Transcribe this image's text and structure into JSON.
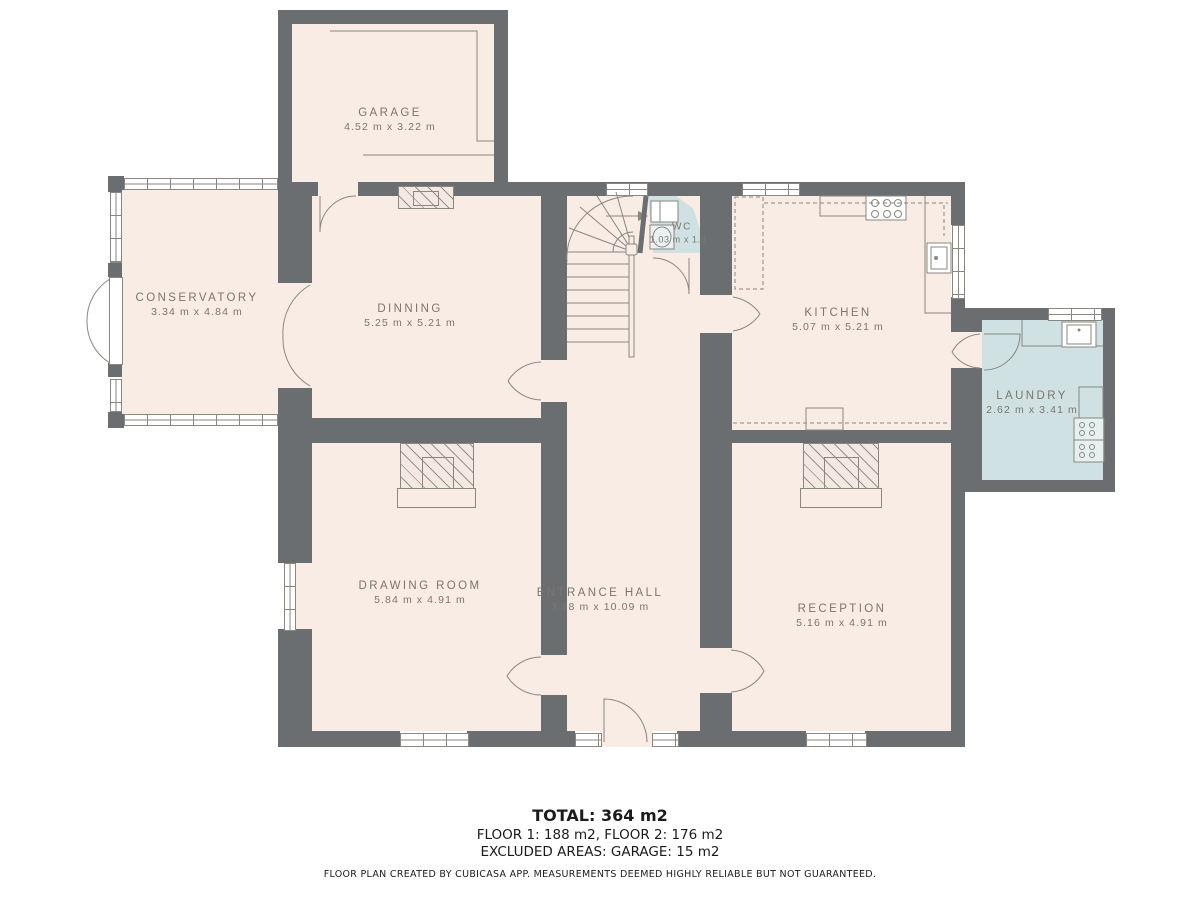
{
  "plan": {
    "title": "floor-plan",
    "rooms": [
      {
        "id": "garage",
        "name": "GARAGE",
        "dims": "4.52 m x 3.22 m"
      },
      {
        "id": "conservatory",
        "name": "CONSERVATORY",
        "dims": "3.34 m x 4.84 m"
      },
      {
        "id": "dinning",
        "name": "DINNING",
        "dims": "5.25 m x 5.21 m"
      },
      {
        "id": "wc",
        "name": "WC",
        "dims": "1.03 m x 1.3"
      },
      {
        "id": "kitchen",
        "name": "KITCHEN",
        "dims": "5.07 m x 5.21 m"
      },
      {
        "id": "laundry",
        "name": "LAUNDRY",
        "dims": "2.62 m x 3.41 m"
      },
      {
        "id": "drawing-room",
        "name": "DRAWING ROOM",
        "dims": "5.84 m x 4.91 m"
      },
      {
        "id": "entrance-hall",
        "name": "ENTRANCE HALL",
        "dims": "3.88 m x 10.09 m"
      },
      {
        "id": "reception",
        "name": "RECEPTION",
        "dims": "5.16 m x 4.91 m"
      }
    ],
    "colors": {
      "wall": "#6b6e70",
      "floor": "#f8ece5",
      "wet_room": "#cfe1e3",
      "label": "#7c766c",
      "line": "#8a8680"
    }
  },
  "footer": {
    "total": "TOTAL: 364 m2",
    "floors": "FLOOR 1: 188 m2, FLOOR 2: 176 m2",
    "excluded": "EXCLUDED AREAS: GARAGE: 15 m2",
    "disclaimer": "FLOOR PLAN CREATED BY CUBICASA APP. MEASUREMENTS DEEMED HIGHLY RELIABLE BUT NOT GUARANTEED."
  }
}
